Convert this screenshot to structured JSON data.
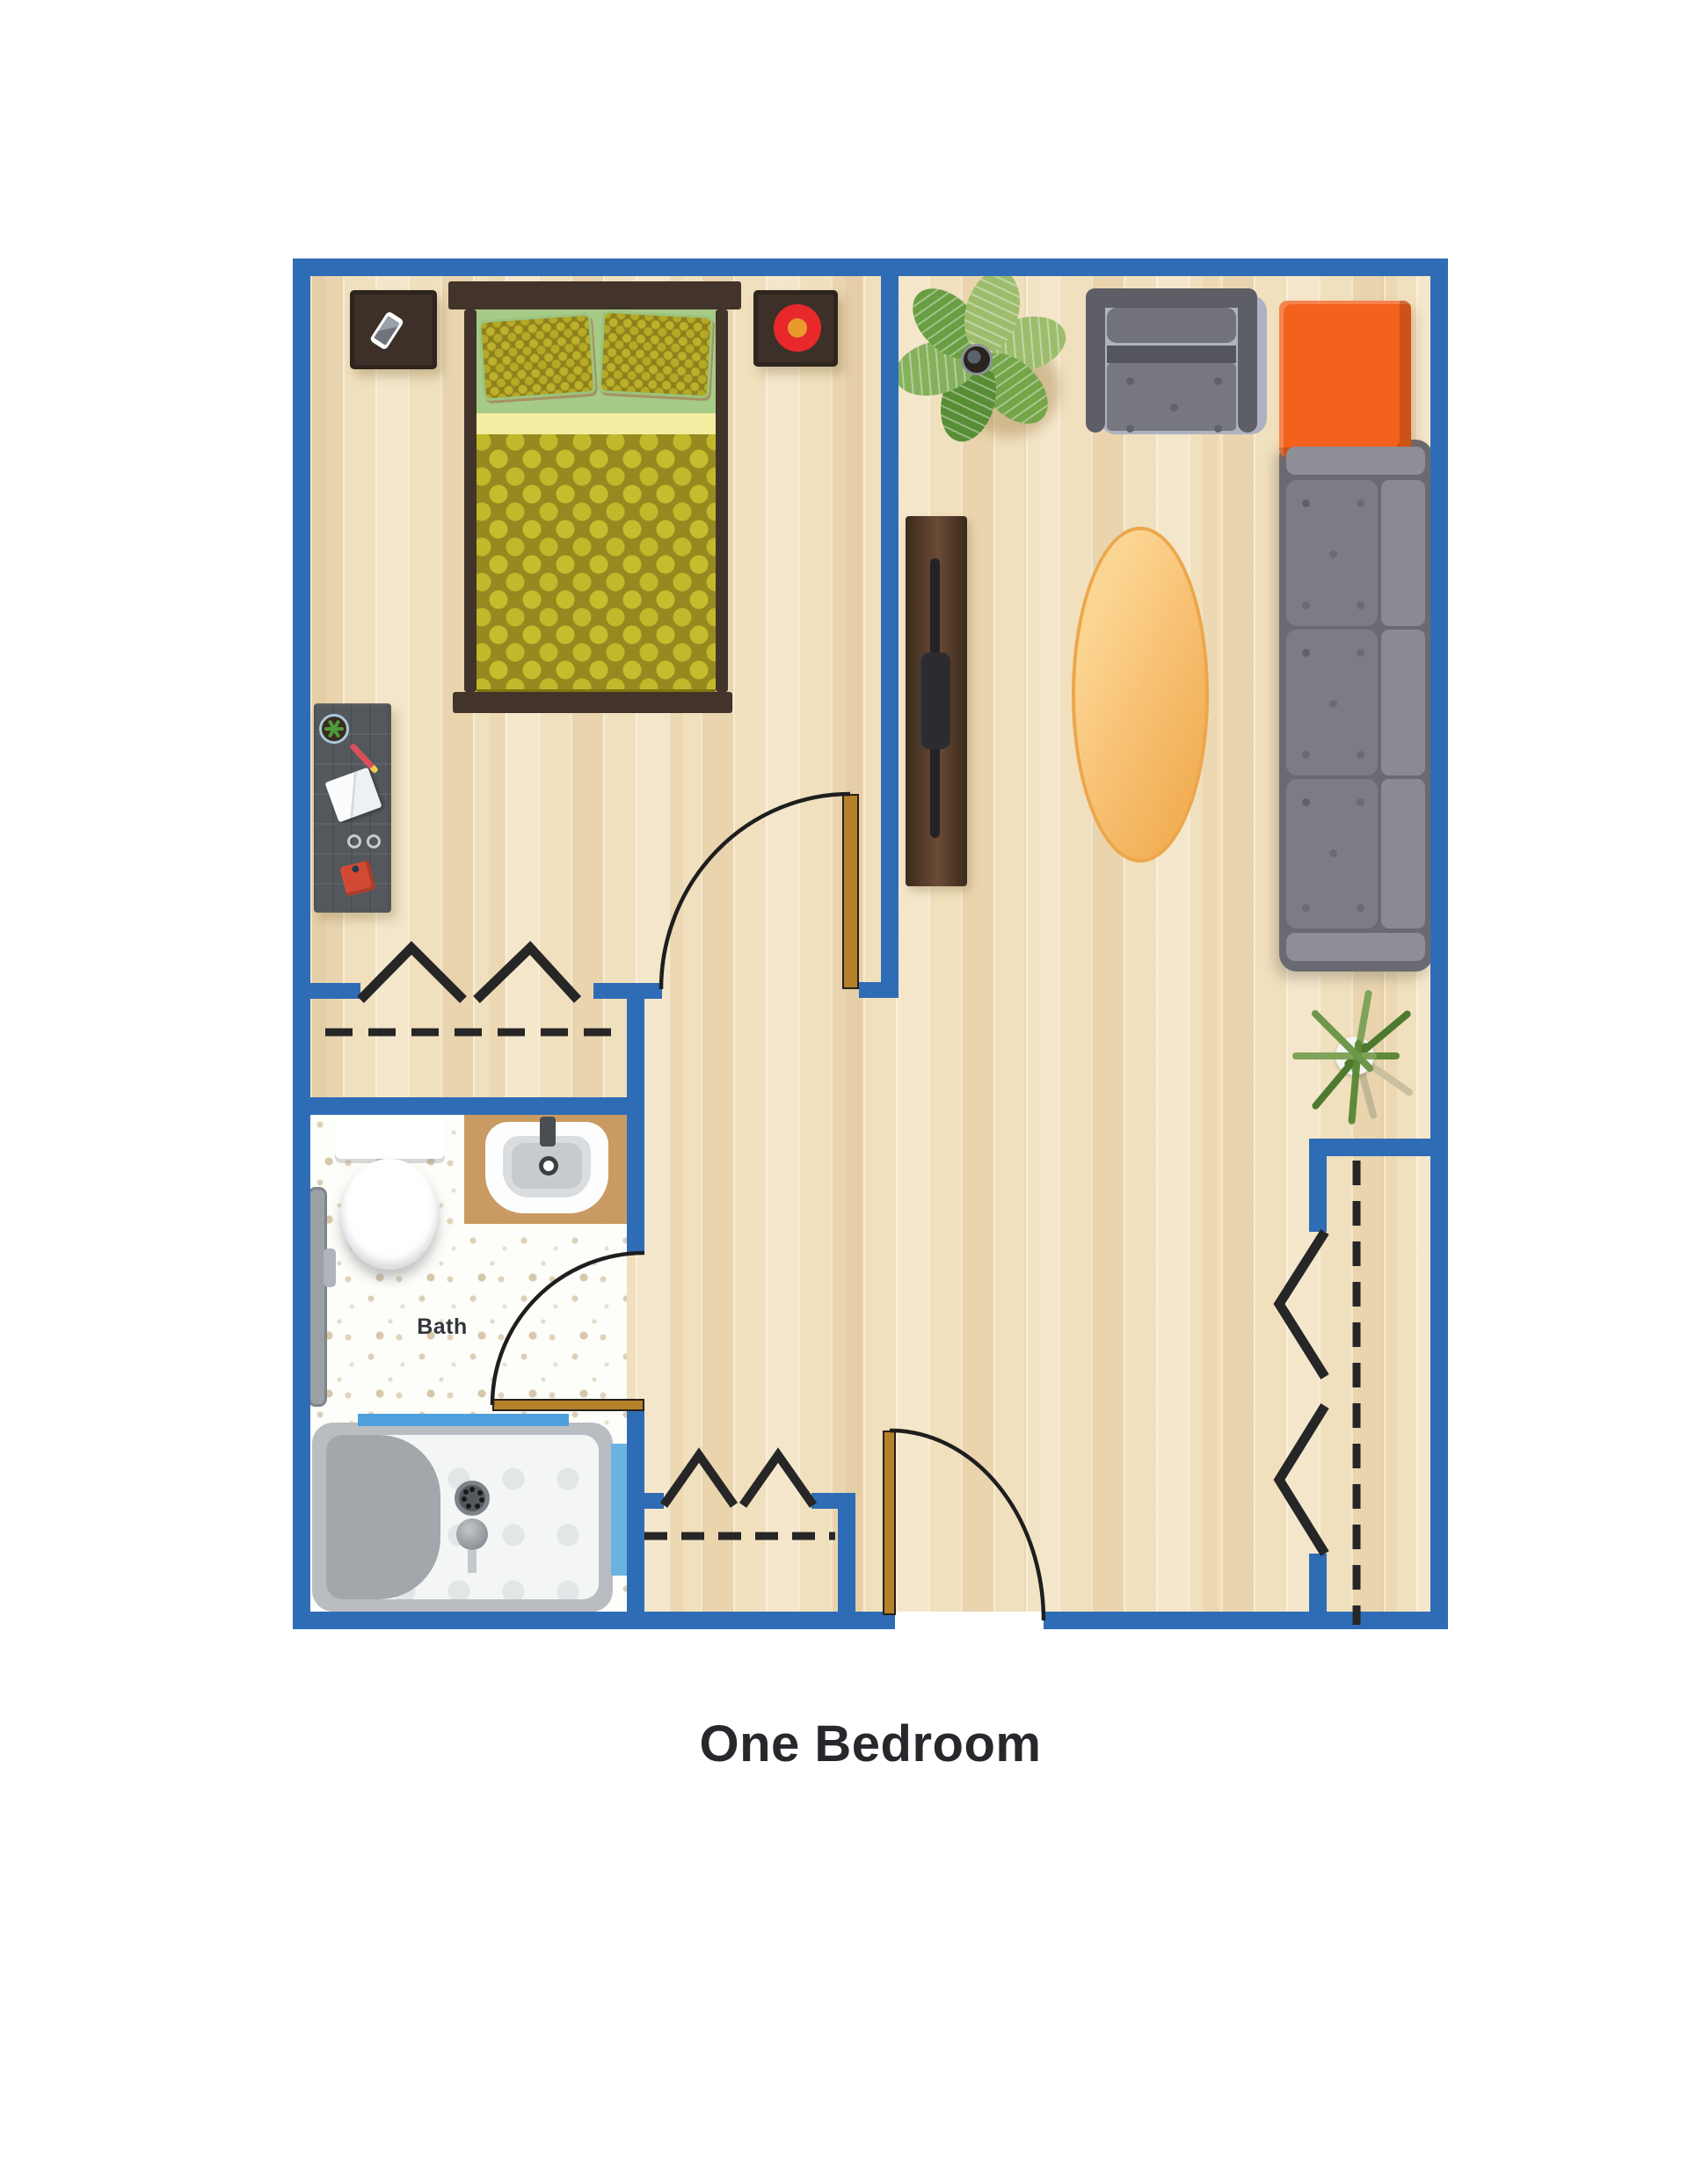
{
  "title": {
    "label": "One Bedroom"
  },
  "rooms": {
    "bath_label": "Bath"
  },
  "palette": {
    "wall_blue": "#2f6cb6",
    "wood_floor": "#f1e0bd",
    "bath_floor": "#fdfdfa",
    "door_wood": "#b5812b",
    "blanket_olive": "#95891f",
    "blanket_dot": "#c6bd2e",
    "sheet_green": "#a5cb87",
    "sheet_yellow": "#f4eda2",
    "furniture_brown": "#42342a",
    "sofa_gray": "#7c7c84",
    "accent_orange": "#f3611d",
    "rug_gold": "#f8c377",
    "decor_red": "#e8282a",
    "tub_accent_blue": "#4da0dc"
  },
  "elements": [
    "double-bed",
    "pillow",
    "nightstand",
    "phone",
    "decor-plate",
    "desk",
    "armchair",
    "side-table",
    "sofa",
    "oval-rug",
    "tv-console",
    "leafy-plant",
    "rosemary-plant",
    "closet-rod",
    "hanger-symbol",
    "toilet",
    "sink",
    "bathtub",
    "grab-bar",
    "door"
  ]
}
